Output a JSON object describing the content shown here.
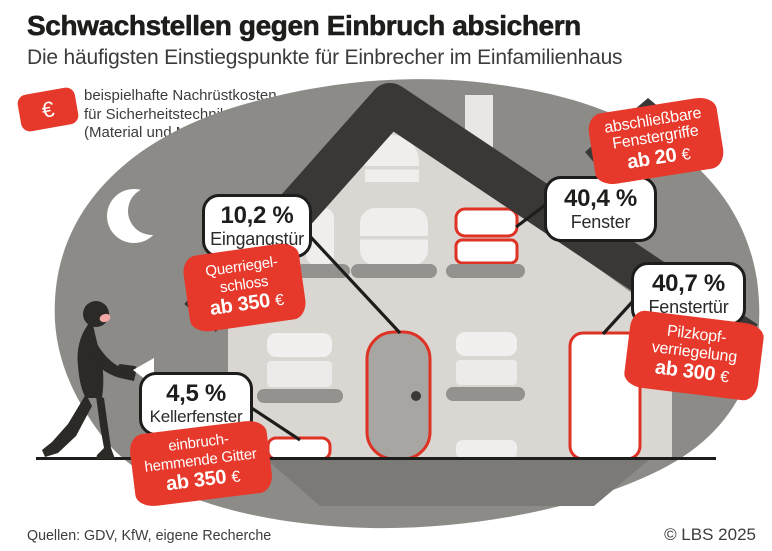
{
  "header": {
    "title": "Schwachstellen gegen Einbruch absichern",
    "subtitle": "Die häufigsten Einstiegspunkte für Einbrecher im Einfamilienhaus"
  },
  "legend": {
    "euro_symbol": "€",
    "lines": [
      "beispielhafte Nachrüstkosten",
      "für Sicherheitstechnik",
      "(Material und Montage)"
    ]
  },
  "callouts": [
    {
      "id": "eingangstuer",
      "percent": "10,2 %",
      "label": "Eingangstür",
      "tag_lines": [
        "Querriegel-",
        "schloss"
      ],
      "tag_price": "ab 350",
      "tag_currency": "€"
    },
    {
      "id": "fenster",
      "percent": "40,4 %",
      "label": "Fenster",
      "tag_lines": [
        "abschließbare",
        "Fenstergriffe"
      ],
      "tag_price": "ab 20",
      "tag_currency": "€"
    },
    {
      "id": "fenstertuer",
      "percent": "40,7 %",
      "label": "Fenstertür",
      "tag_lines": [
        "Pilzkopf-",
        "verriegelung"
      ],
      "tag_price": "ab 300",
      "tag_currency": "€"
    },
    {
      "id": "kellerfenster",
      "percent": "4,5 %",
      "label": "Kellerfenster",
      "tag_lines": [
        "einbruch-",
        "hemmende Gitter"
      ],
      "tag_price": "ab 350",
      "tag_currency": "€"
    }
  ],
  "footer": {
    "sources": "Quellen: GDV, KfW, eigene Recherche",
    "copyright": "© LBS 2025"
  },
  "colors": {
    "red": "#e6392b",
    "red_stroke": "#dd3224",
    "dark": "#3a3836",
    "text_dark": "#1d1d1b",
    "gray_blob": "#8c8b87",
    "ground_shadow": "#7b7a76",
    "facade": "#dad7d3",
    "window_cream": "#efeeec",
    "sill_gray": "#94928e",
    "door_gray": "#a8a6a2",
    "burglar": "#2b2a27",
    "face_pink": "#f2a9a6"
  },
  "chart_data": {
    "type": "bar",
    "title": "Die häufigsten Einstiegspunkte für Einbrecher im Einfamilienhaus",
    "categories": [
      "Fenstertür",
      "Fenster",
      "Eingangstür",
      "Kellerfenster"
    ],
    "values": [
      40.7,
      40.4,
      10.2,
      4.5
    ],
    "unit": "%",
    "annotations": [
      {
        "category": "Fenstertür",
        "measure": "Pilzkopfverriegelung",
        "price": "ab 300 €"
      },
      {
        "category": "Fenster",
        "measure": "abschließbare Fenstergriffe",
        "price": "ab 20 €"
      },
      {
        "category": "Eingangstür",
        "measure": "Querriegelschloss",
        "price": "ab 350 €"
      },
      {
        "category": "Kellerfenster",
        "measure": "einbruchhemmende Gitter",
        "price": "ab 350 €"
      }
    ]
  }
}
